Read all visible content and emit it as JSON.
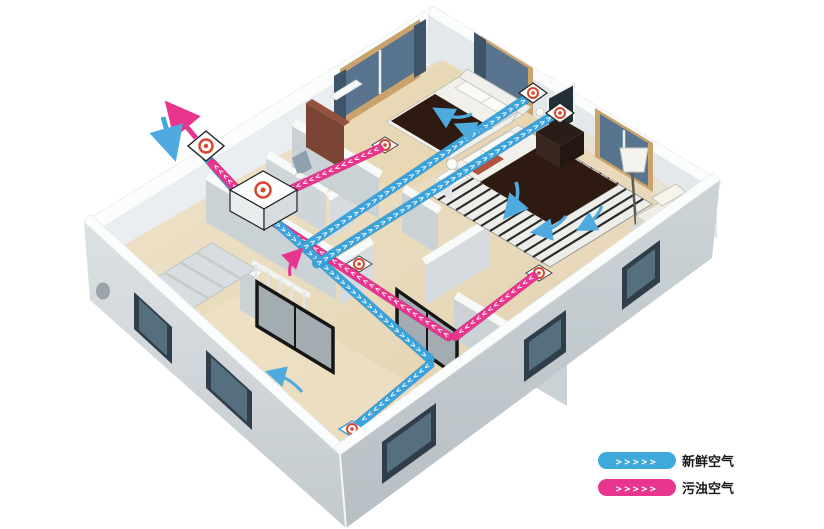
{
  "diagram": {
    "type": "isometric-cutaway-floorplan",
    "subject": "home fresh-air ventilation system with supply and exhaust ducts"
  },
  "legend": {
    "items": [
      {
        "chevrons": ">>>>>",
        "label": "新鲜空气",
        "color": "#3FA9DC"
      },
      {
        "chevrons": ">>>>>",
        "label": "污浊空气",
        "color": "#E8368F"
      }
    ]
  },
  "flows": {
    "supply": {
      "intake": ">>>>>>>",
      "trunk": ">>>>>>>>>>>>>>>>>>>>>>>>>>>>>>",
      "living": ">>>>>>>>>>>>",
      "bedroom": ">>>>>>>>>>>>>>>>>>>>>>>>>>>>>>>>>>>>",
      "master": ">>>>>>>>>>>>>>>>>>>>>>>>>>>>>>>>>>>>>"
    },
    "exhaust": {
      "bedroom": ">>>>>>>>>>>>>>>>>",
      "master": ">>>>>>>>>>>>>",
      "corridor": ">>>>>>>>>>>>>>>>>>>>>>>>>>>>",
      "outlet": ">>>>>>"
    }
  },
  "colors": {
    "supply_duct": "#3BA3DC",
    "exhaust_duct": "#E8368F",
    "vent_ring": "#D9452C",
    "walls": "#D3D9DC",
    "floor": "#EADCC1"
  },
  "components": {
    "ventilation_unit": "heat-recovery-ventilation-unit",
    "exterior_wall_vent": "intake-exhaust-wall-vent",
    "supply_diffusers": [
      "bedroom-wall-diffuser",
      "master-bedroom-wall-diffuser",
      "living-room-floor-diffuser"
    ],
    "exhaust_grilles": [
      "small-bedroom-grille",
      "corridor-grille",
      "master-bedroom-grille"
    ]
  }
}
